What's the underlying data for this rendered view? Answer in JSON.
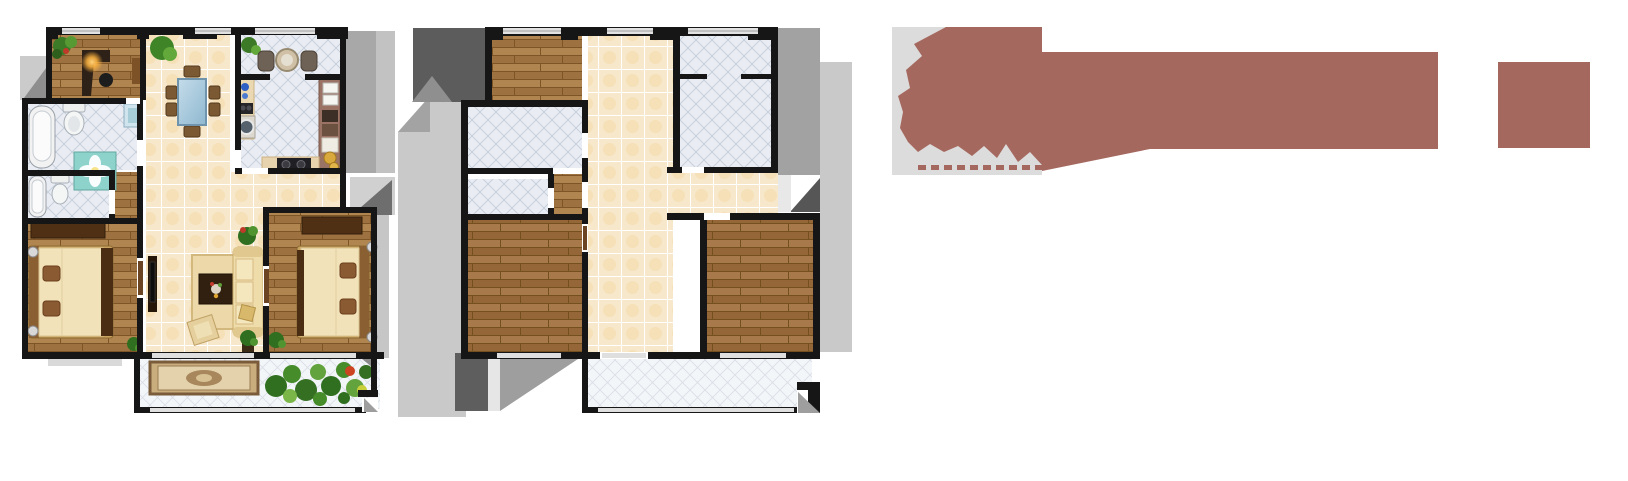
{
  "canvas": {
    "width": 1628,
    "height": 481,
    "background": "#ffffff"
  },
  "colors": {
    "accent_maroon": "#a5685e",
    "logo_panel_gray": "#dcdcdc",
    "wall": "#161616",
    "cream_tile": "#f8e8cb",
    "blue_gray_tile": "#e9edf3",
    "white_tile": "#f3f6f9",
    "wood": "#a97c48",
    "wood_dark": "#9c6e3e",
    "shadow_dark": "#5c5c5c",
    "shadow_mid": "#9e9e9e",
    "shadow_light": "#c9c9c9"
  },
  "branding": {
    "mark": "calligraphic-brush-mark",
    "fine_print": "illegible-micro-text-row",
    "band": "solid-title-band",
    "badge": "square-seal"
  },
  "floorplans": [
    {
      "name": "furnished-apartment-plan",
      "style": "furnished top-down render",
      "rooms": [
        "study",
        "dining-area",
        "breakfast-nook",
        "kitchen",
        "main-bathroom",
        "second-bathroom",
        "left-bedroom",
        "living-room",
        "right-bedroom",
        "south-balcony"
      ]
    },
    {
      "name": "unfurnished-apartment-plan",
      "style": "empty top-down render with extruded shadows",
      "rooms": [
        "top-left-bedroom",
        "mid-storage-room",
        "small-storage-room",
        "entry-hall",
        "top-right-room",
        "bottom-left-bedroom",
        "bottom-right-bedroom",
        "south-balcony"
      ]
    }
  ]
}
